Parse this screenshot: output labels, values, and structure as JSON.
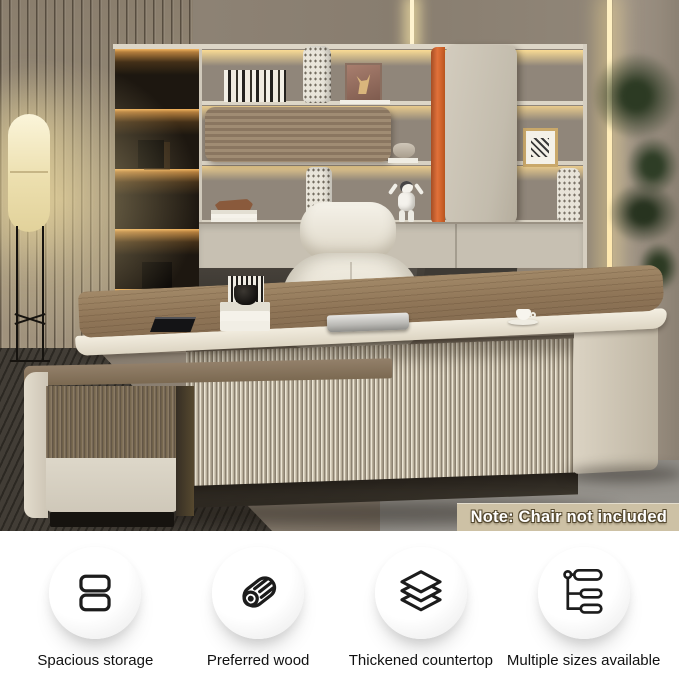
{
  "badge": {
    "text": "Note: Chair not included",
    "bg": "#cdc1a5",
    "text_color": "#ffffff",
    "outline_color": "#55492f"
  },
  "features": {
    "items": [
      {
        "label": "Spacious storage",
        "icon": "drawers-icon"
      },
      {
        "label": "Preferred wood",
        "icon": "wood-log-icon"
      },
      {
        "label": "Thickened countertop",
        "icon": "layers-icon"
      },
      {
        "label": "Multiple sizes available",
        "icon": "size-options-icon"
      }
    ]
  },
  "colors": {
    "accent_orange": "#e0713a",
    "desk_wood": "#97805f",
    "cream": "#e9e2d2",
    "wall_taupe": "#8b8072",
    "feature_text": "#111111"
  }
}
